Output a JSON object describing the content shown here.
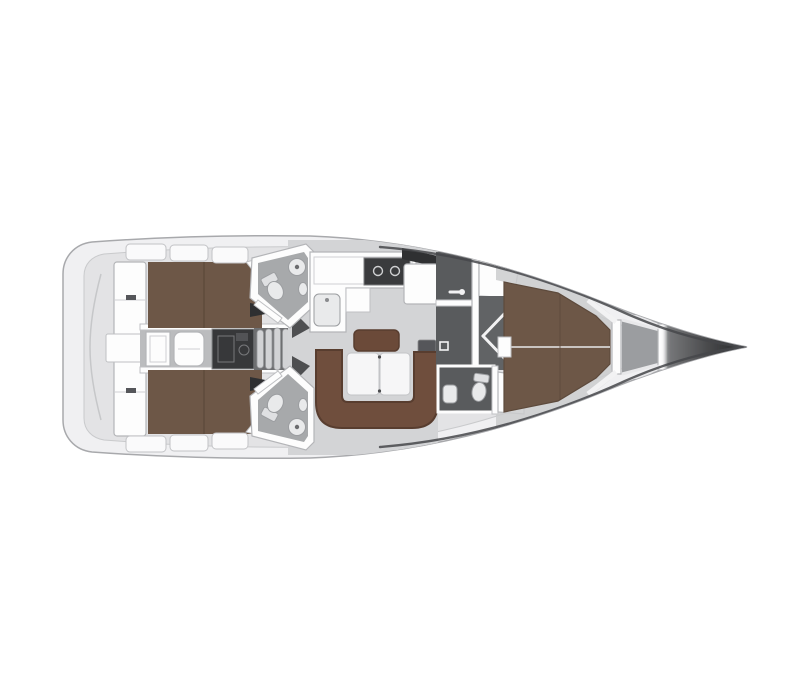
{
  "page": {
    "background": "#ffffff"
  },
  "colors": {
    "hull": "#f0f0f2",
    "hull_stroke": "#a8a9ac",
    "deck_inner": "#e3e3e5",
    "floor_salon": "#d3d4d6",
    "floor_corridor": "#bbbcbe",
    "berth": "#6d5747",
    "berth_dark": "#5d4a3c",
    "settee": "#6f4e3d",
    "settee_edge": "#583d2f",
    "bench": "#6b4a39",
    "table": "#f6f6f7",
    "head_floor": "#a7a9ab",
    "dark_room": "#595b5d",
    "corridor_dark": "#616365",
    "engine": "#37383a",
    "steps_base": "#6e6f71",
    "step": "#d2d3d5",
    "stove": "#3a3b3d",
    "hatch": "#2f3032",
    "nav_seat": "#55565a",
    "anchor_locker": "#9b9da0",
    "door_wedge": "#2e2f31",
    "wall_wedge": "#4e4f51"
  },
  "rooms": [
    {
      "name": "stern-platform"
    },
    {
      "name": "port-aft-cabin"
    },
    {
      "name": "starboard-aft-cabin"
    },
    {
      "name": "engine-room"
    },
    {
      "name": "companionway-steps"
    },
    {
      "name": "port-aft-head"
    },
    {
      "name": "starboard-aft-head"
    },
    {
      "name": "galley"
    },
    {
      "name": "nav-station"
    },
    {
      "name": "salon"
    },
    {
      "name": "forward-head"
    },
    {
      "name": "shower-compartment"
    },
    {
      "name": "forward-cabin"
    },
    {
      "name": "anchor-locker"
    },
    {
      "name": "bow"
    }
  ],
  "fixtures": [
    {
      "name": "toilet"
    },
    {
      "name": "shower-drain"
    },
    {
      "name": "sink"
    },
    {
      "name": "stove-burners"
    },
    {
      "name": "salon-table"
    },
    {
      "name": "v-berth"
    },
    {
      "name": "double-berth"
    },
    {
      "name": "folding-door"
    }
  ]
}
